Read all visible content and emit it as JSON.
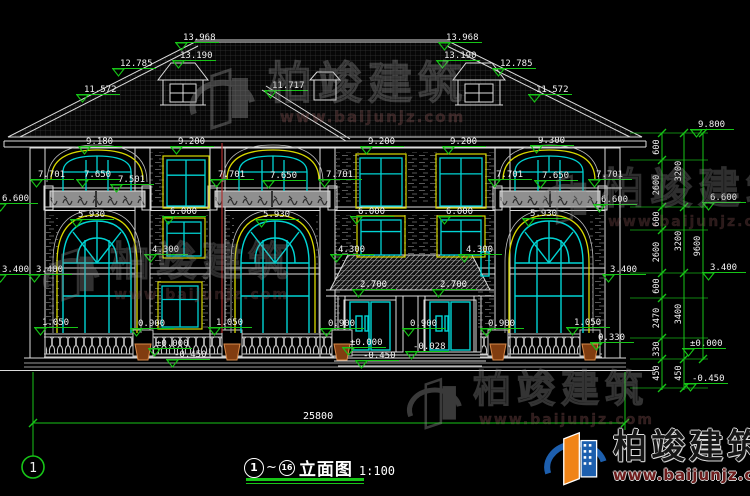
{
  "drawing": {
    "grid_bubble": "1",
    "title_no_from": "1",
    "title_tilde": "~",
    "title_no_to": "16",
    "title": "立面图",
    "scale": "1:100",
    "total_width_dim": "25800"
  },
  "watermark": {
    "brand": "柏竣建筑",
    "url": "www.baijunjz.com"
  },
  "logo": {
    "brand": "柏竣建筑",
    "url": "www.baijunjz.com"
  },
  "colors": {
    "dim_green": "#17c517",
    "window_cyan": "#00d4d4",
    "trim_yellow": "#d9d900",
    "line_white": "#dcdcdc",
    "axis_red": "#b03030",
    "logo_blue": "#1d5fae",
    "logo_orange": "#f08418",
    "url_maroon": "#6e1c1c"
  },
  "level_flags": [
    {
      "t": "13.968",
      "x": 183,
      "y": 40
    },
    {
      "t": "13.190",
      "x": 180,
      "y": 58
    },
    {
      "t": "12.785",
      "x": 120,
      "y": 66
    },
    {
      "t": "11.572",
      "x": 84,
      "y": 92
    },
    {
      "t": "11.717",
      "x": 272,
      "y": 88
    },
    {
      "t": "13.968",
      "x": 446,
      "y": 40
    },
    {
      "t": "13.190",
      "x": 444,
      "y": 58
    },
    {
      "t": "12.785",
      "x": 500,
      "y": 66
    },
    {
      "t": "11.572",
      "x": 536,
      "y": 92
    },
    {
      "t": "9.180",
      "x": 86,
      "y": 144
    },
    {
      "t": "9.200",
      "x": 178,
      "y": 144
    },
    {
      "t": "9.200",
      "x": 368,
      "y": 144
    },
    {
      "t": "9.200",
      "x": 450,
      "y": 144
    },
    {
      "t": "9.300",
      "x": 538,
      "y": 143
    },
    {
      "t": "7.701",
      "x": 38,
      "y": 177
    },
    {
      "t": "7.650",
      "x": 84,
      "y": 177
    },
    {
      "t": "7.501",
      "x": 118,
      "y": 182
    },
    {
      "t": "7.701",
      "x": 218,
      "y": 177
    },
    {
      "t": "7.650",
      "x": 270,
      "y": 178
    },
    {
      "t": "7.701",
      "x": 326,
      "y": 177
    },
    {
      "t": "7.701",
      "x": 496,
      "y": 177
    },
    {
      "t": "7.650",
      "x": 542,
      "y": 178
    },
    {
      "t": "7.701",
      "x": 596,
      "y": 177
    },
    {
      "t": "6.600",
      "x": 2,
      "y": 201
    },
    {
      "t": "6.600",
      "x": 601,
      "y": 202
    },
    {
      "t": "6.600",
      "x": 710,
      "y": 200
    },
    {
      "t": "5.930",
      "x": 78,
      "y": 217
    },
    {
      "t": "6.000",
      "x": 170,
      "y": 214
    },
    {
      "t": "5.930",
      "x": 263,
      "y": 217
    },
    {
      "t": "6.000",
      "x": 358,
      "y": 214
    },
    {
      "t": "6.000",
      "x": 446,
      "y": 214
    },
    {
      "t": "5.930",
      "x": 530,
      "y": 216
    },
    {
      "t": "4.300",
      "x": 152,
      "y": 252
    },
    {
      "t": "4.300",
      "x": 338,
      "y": 252
    },
    {
      "t": "4.300",
      "x": 466,
      "y": 252
    },
    {
      "t": "3.400",
      "x": 2,
      "y": 272
    },
    {
      "t": "3.400",
      "x": 36,
      "y": 272
    },
    {
      "t": "3.400",
      "x": 610,
      "y": 272
    },
    {
      "t": "3.400",
      "x": 710,
      "y": 270
    },
    {
      "t": "2.700",
      "x": 360,
      "y": 287
    },
    {
      "t": "2.700",
      "x": 440,
      "y": 287
    },
    {
      "t": "1.050",
      "x": 42,
      "y": 325
    },
    {
      "t": "0.900",
      "x": 138,
      "y": 326
    },
    {
      "t": "1.050",
      "x": 216,
      "y": 325
    },
    {
      "t": "0.900",
      "x": 328,
      "y": 326
    },
    {
      "t": "0.900",
      "x": 410,
      "y": 326
    },
    {
      "t": "0.900",
      "x": 488,
      "y": 326
    },
    {
      "t": "1.050",
      "x": 574,
      "y": 325
    },
    {
      "t": "0.330",
      "x": 598,
      "y": 340
    },
    {
      "t": "±0.000",
      "x": 156,
      "y": 346
    },
    {
      "t": "±0.000",
      "x": 350,
      "y": 345
    },
    {
      "t": "-0.028",
      "x": 413,
      "y": 349
    },
    {
      "t": "-0.450",
      "x": 174,
      "y": 357
    },
    {
      "t": "-0.450",
      "x": 363,
      "y": 358
    },
    {
      "t": "9.800",
      "x": 698,
      "y": 127
    },
    {
      "t": "±0.000",
      "x": 690,
      "y": 346
    },
    {
      "t": "-0.450",
      "x": 692,
      "y": 381
    }
  ],
  "vertical_dims": [
    {
      "t": "600",
      "x": 662,
      "y": 147
    },
    {
      "t": "2600",
      "x": 662,
      "y": 185
    },
    {
      "t": "600",
      "x": 662,
      "y": 219
    },
    {
      "t": "2600",
      "x": 662,
      "y": 252
    },
    {
      "t": "600",
      "x": 662,
      "y": 286
    },
    {
      "t": "2470",
      "x": 662,
      "y": 318
    },
    {
      "t": "330",
      "x": 662,
      "y": 349
    },
    {
      "t": "450",
      "x": 662,
      "y": 373
    },
    {
      "t": "3200",
      "x": 684,
      "y": 171
    },
    {
      "t": "3200",
      "x": 684,
      "y": 241
    },
    {
      "t": "3400",
      "x": 684,
      "y": 314
    },
    {
      "t": "450",
      "x": 684,
      "y": 373
    },
    {
      "t": "9600",
      "x": 703,
      "y": 246
    }
  ]
}
